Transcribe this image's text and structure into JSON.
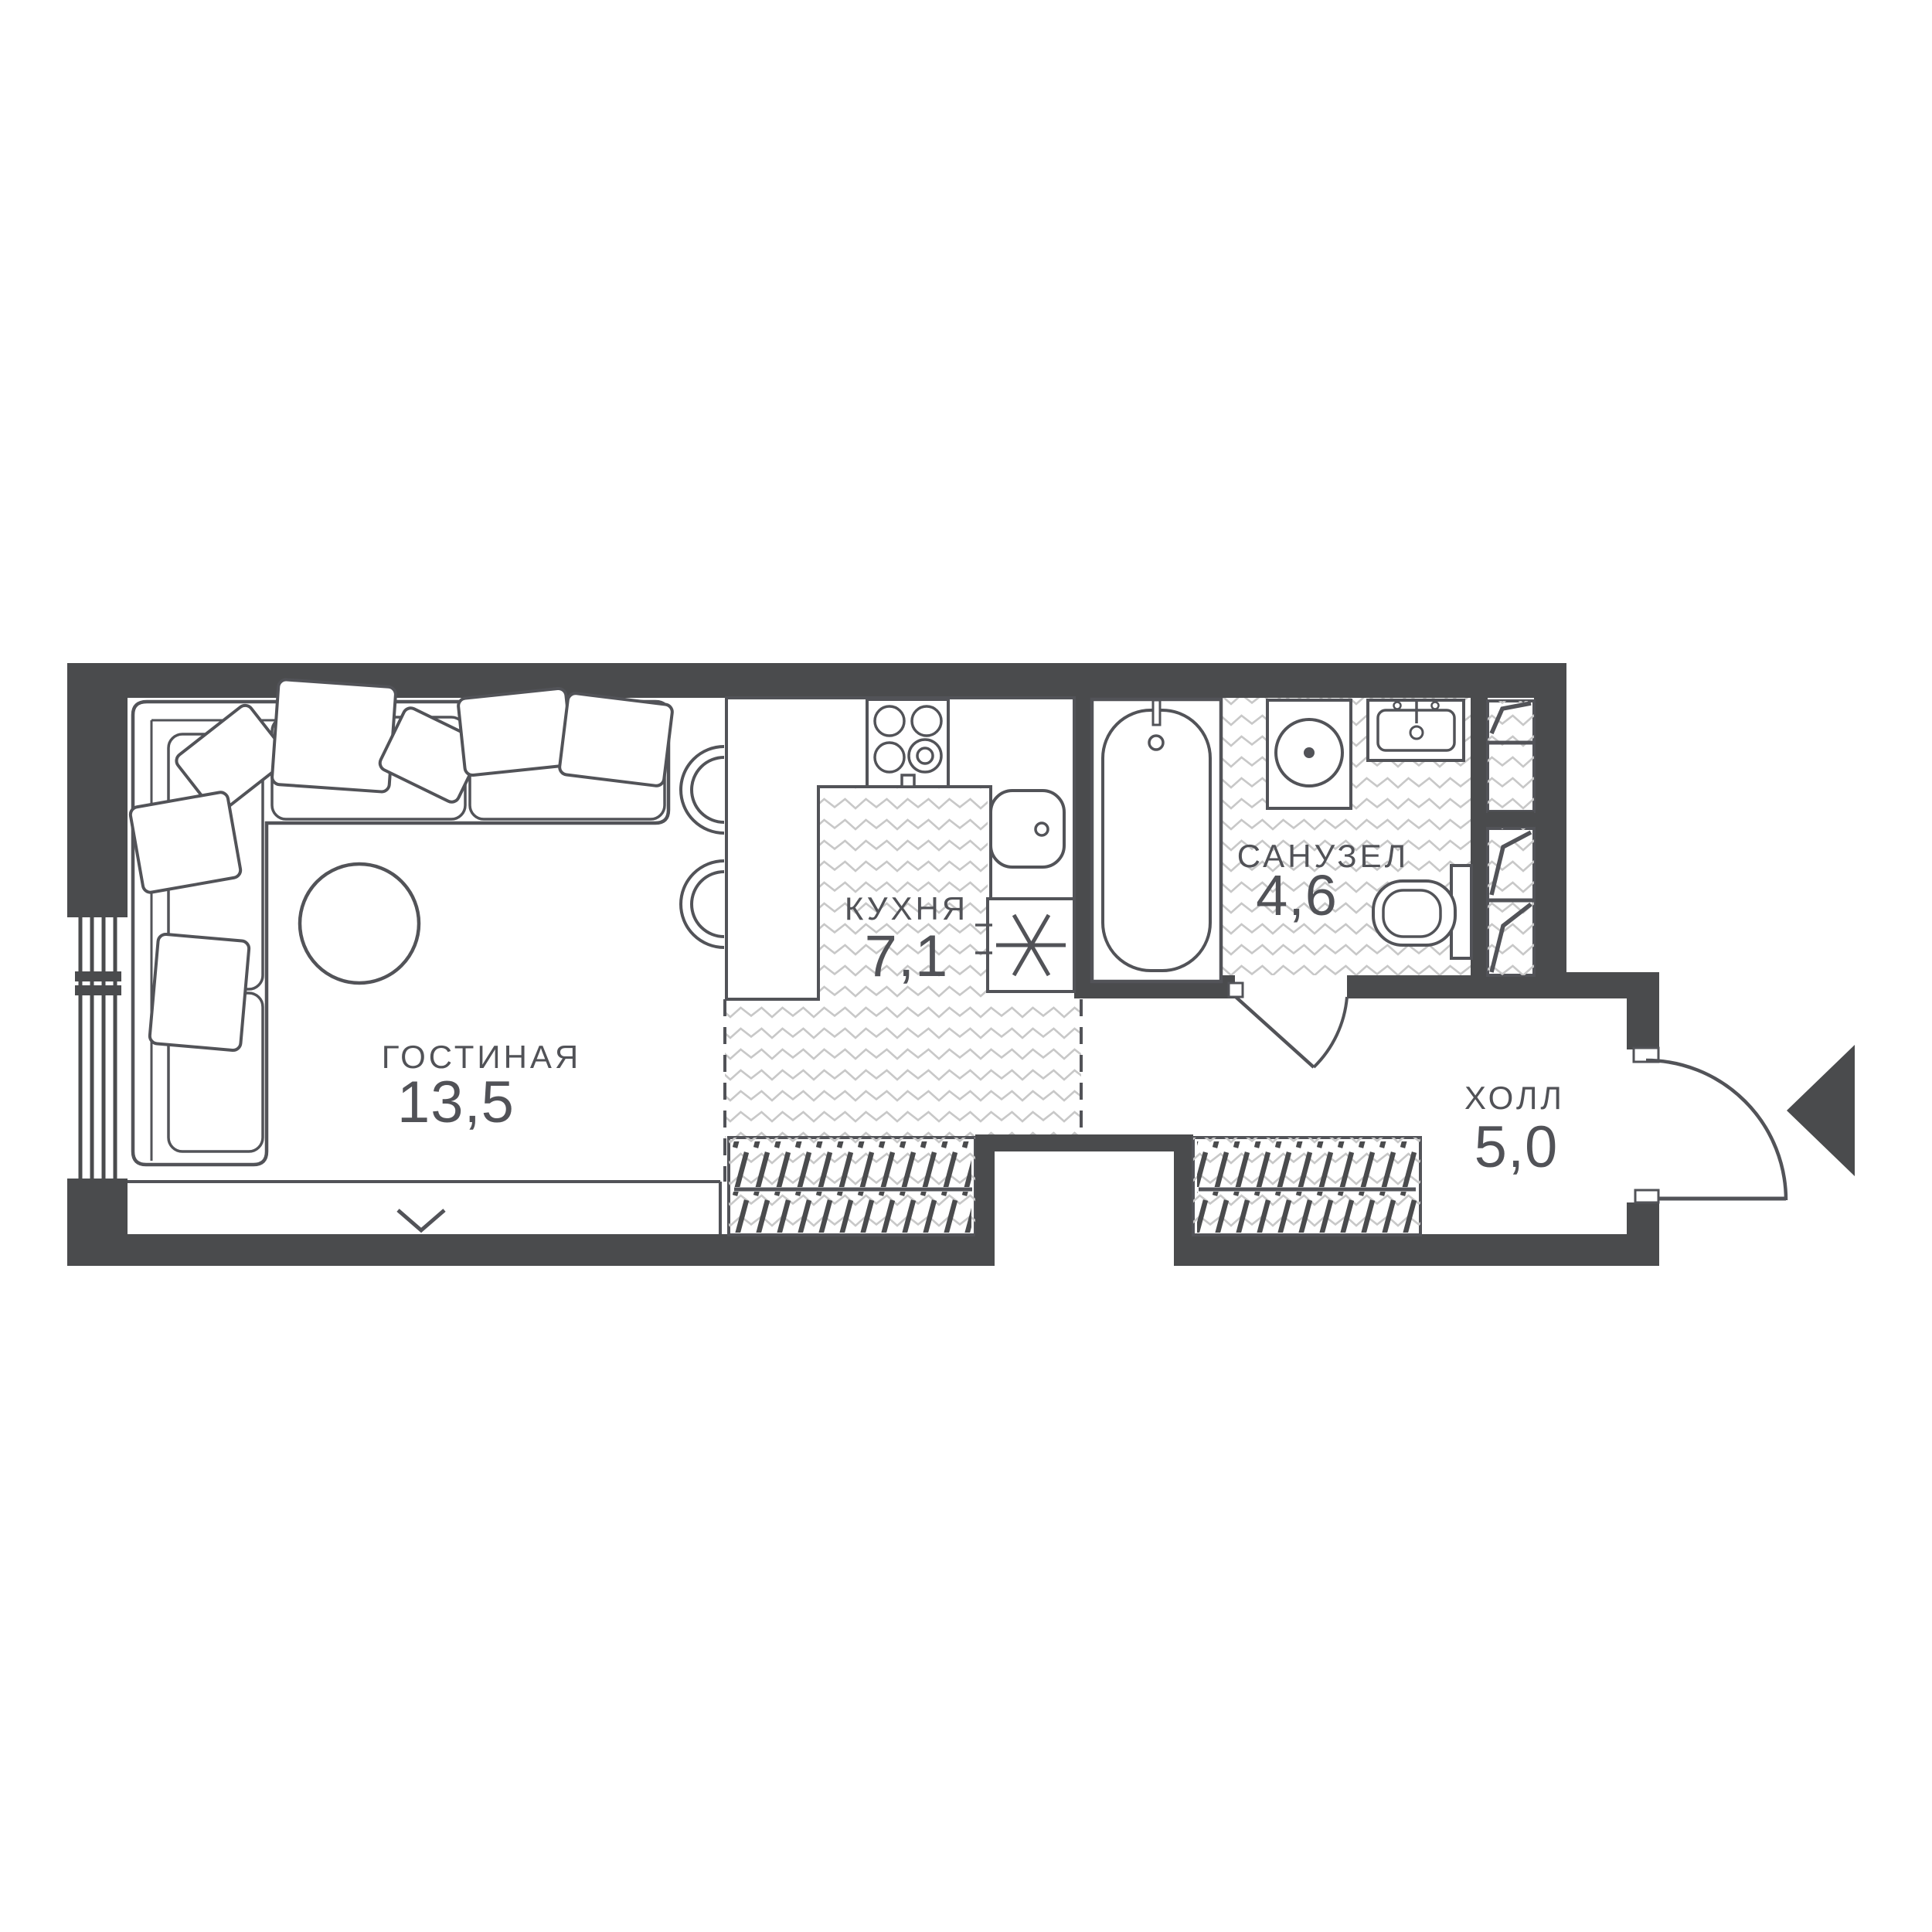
{
  "plan": {
    "rooms": [
      {
        "id": "living",
        "name": "ГОСТИНАЯ",
        "area": "13,5"
      },
      {
        "id": "kitchen",
        "name": "КУХНЯ",
        "area": "7,1"
      },
      {
        "id": "bathroom",
        "name": "САНУЗЕЛ",
        "area": "4,6"
      },
      {
        "id": "hall",
        "name": "ХОЛЛ",
        "area": "5,0"
      }
    ],
    "colors": {
      "wall": "#4a4b4d",
      "furniture_line": "#525358",
      "hatch": "#c8c8c8",
      "label_text": "#515257",
      "background": "#ffffff"
    },
    "symbols": [
      "entrance-arrow",
      "door-swing-arc",
      "window-glazing",
      "window-sill-chevron",
      "sofa",
      "pillow",
      "coffee-table",
      "bar-stool",
      "stove",
      "kitchen-sink",
      "washing-machine",
      "asterisk-appliance",
      "bathtub",
      "bathroom-sink",
      "toilet",
      "wardrobe-hatch",
      "shelving-unit",
      "wall-niche"
    ]
  }
}
